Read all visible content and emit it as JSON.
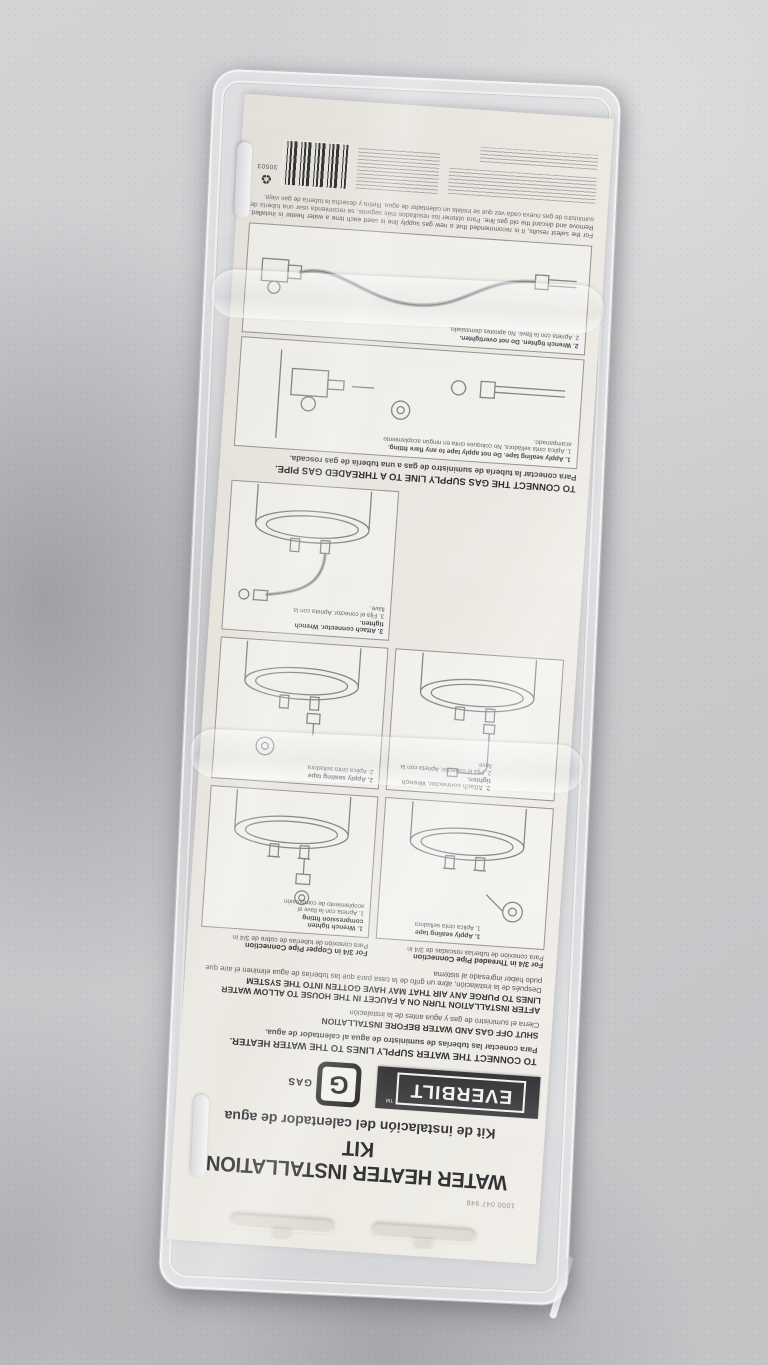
{
  "colors": {
    "surface": "#cbccce",
    "card": "#eae7e0",
    "brand_bar": "#2b2b2d",
    "ink": "#232326",
    "diagram_line": "#7d7d81"
  },
  "package": {
    "card": {
      "sku_number": "1000 047 948",
      "title_en": "WATER HEATER INSTALLATION KIT",
      "title_es": "Kit de instalación del calentador de agua",
      "brand": {
        "name": "EVERBILT",
        "tm": "TM",
        "badge_letter": "G",
        "badge_label": "GAS"
      },
      "water": {
        "heading_en": "TO CONNECT THE WATER SUPPLY LINES TO THE WATER HEATER.",
        "heading_es": "Para conectar las tuberías de suministro de agua al calentador de agua.",
        "warning1_en": "SHUT OFF GAS AND WATER BEFORE INSTALLATION",
        "warning1_es": "Cierra el suministro de gas y agua antes de la instalación",
        "warning2_en": "AFTER INSTALLATION TURN ON A FAUCET IN THE HOUSE TO ALLOW WATER LINES TO PURGE ANY AIR THAT MAY HAVE GOTTEN INTO THE SYSTEM",
        "warning2_es": "Después de la instalación, abre un grifo de la casa para que las tuberías de agua eliminen el aire que pudo haber ingresado al sistema",
        "columns": [
          {
            "header_en": "For 3/4 in Threaded Pipe Connection",
            "header_es": "Para conexión de tuberías roscadas de 3/4 in",
            "steps": [
              {
                "en": "1. Apply sealing tape",
                "es": "1. Aplica cinta selladora"
              },
              {
                "en": "2. Attach connector. Wrench tighten.",
                "es": "2. Fija el conector. Aprieta con la llave."
              }
            ]
          },
          {
            "header_en": "For 3/4 in Copper Pipe Connection",
            "header_es": "Para conexión de tuberías de cobre de 3/4 in",
            "steps": [
              {
                "en": "1. Wrench tighten compression fitting",
                "es": "1. Aprieta con la llave el acoplamiento de compresión"
              },
              {
                "en": "2. Apply sealing tape",
                "es": "2. Aplica cinta selladora"
              },
              {
                "en": "3. Attach connector. Wrench tighten.",
                "es": "3. Fija el conector. Aprieta con la llave."
              }
            ]
          }
        ]
      },
      "gas": {
        "heading_en": "TO CONNECT THE GAS SUPPLY LINE TO A THREADED GAS PIPE.",
        "heading_es": "Para conectar la tubería de suministro de gas a una tubería de gas roscada.",
        "steps": [
          {
            "en": "1. Apply sealing tape. Do not apply tape to any flare fitting.",
            "es": "1. Aplica cinta selladora. No coloques cinta en ningún acoplamiento acampanado."
          },
          {
            "en": "2. Wrench tighten. Do not overtighten.",
            "es": "2. Aprieta con la llave. No aprietes demasiado."
          }
        ]
      },
      "fine_print": {
        "safety_en": "For the safest results, it is recommended that a new gas supply line is used each time a water heater is installed. Remove and discard the old gas line.",
        "safety_es": "Para obtener los resultados más seguros, se recomienda usar una tubería de suministro de gas nueva cada vez que se instala un calentador de agua. Retira y desecha la tubería de gas vieja."
      },
      "barcode_number": "30503"
    }
  }
}
